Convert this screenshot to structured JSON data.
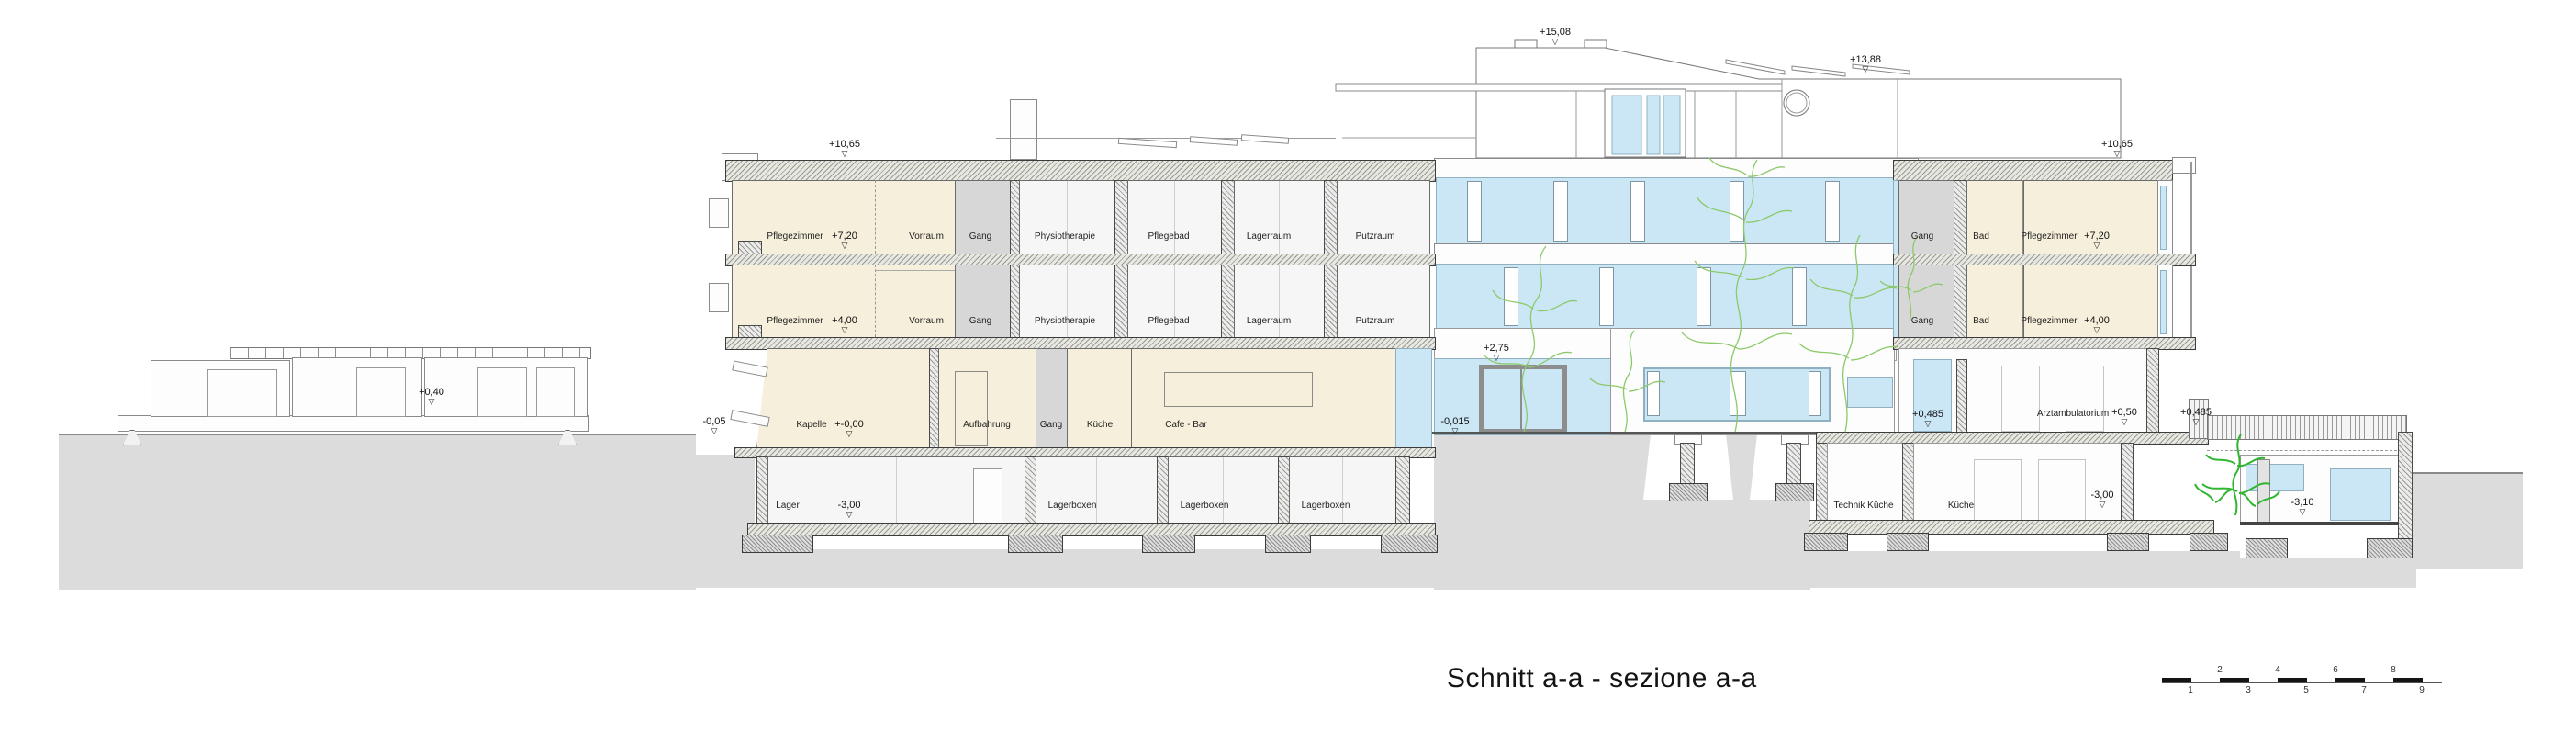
{
  "title": "Schnitt a-a - sezione a-a",
  "glyphs": {
    "level_triangle": "▽"
  },
  "colors": {
    "room_beige": "#f6efdb",
    "corridor_gray": "#d7d7d7",
    "glass_blue": "#cbe7f6",
    "terrain_gray": "#dcdcdc",
    "plant_green": "#7cc45a",
    "plant_green_bright": "#2fb52f"
  },
  "left_wing": {
    "roof_level": "+10,65",
    "floor2": {
      "level": "+7,20",
      "rooms": [
        "Pflegezimmer",
        "Vorraum",
        "Gang",
        "Physiotherapie",
        "Pflegebad",
        "Lagerraum",
        "Putzraum"
      ]
    },
    "floor1": {
      "level": "+4,00",
      "rooms": [
        "Pflegezimmer",
        "Vorraum",
        "Gang",
        "Physiotherapie",
        "Pflegebad",
        "Lagerraum",
        "Putzraum"
      ]
    },
    "ground": {
      "level": "+-0,00",
      "rooms": [
        "Kapelle",
        "Aufbahrung",
        "Gang",
        "Küche",
        "Cafe - Bar"
      ]
    },
    "basement": {
      "level": "-3,00",
      "rooms": [
        "Lager",
        "Lagerboxen",
        "Lagerboxen",
        "Lagerboxen"
      ]
    }
  },
  "tower": {
    "levels": {
      "top": "+15,08",
      "roof": "+13,88",
      "entry": "+2,75",
      "ground": "-0,015"
    }
  },
  "right_wing": {
    "roof_level": "+10,65",
    "floor2": {
      "level": "+7,20",
      "rooms": [
        "Gang",
        "Bad",
        "Pflegezimmer"
      ]
    },
    "floor1": {
      "level": "+4,00",
      "rooms": [
        "Gang",
        "Bad",
        "Pflegezimmer"
      ]
    },
    "ground": {
      "room": "Arztambulatorium",
      "level": "+0,50",
      "level_left": "+0,485",
      "level_right": "+0,485"
    },
    "basement": {
      "rooms": [
        "Technik Küche",
        "Küche"
      ],
      "level": "-3,00"
    }
  },
  "site": {
    "terrace_level": "-0,05",
    "pavilion_level": "+0,40",
    "garden_level": "-3,10"
  },
  "scale_bar": {
    "top": [
      "2",
      "4",
      "6",
      "8"
    ],
    "bottom": [
      "1",
      "3",
      "5",
      "7",
      "9"
    ]
  }
}
